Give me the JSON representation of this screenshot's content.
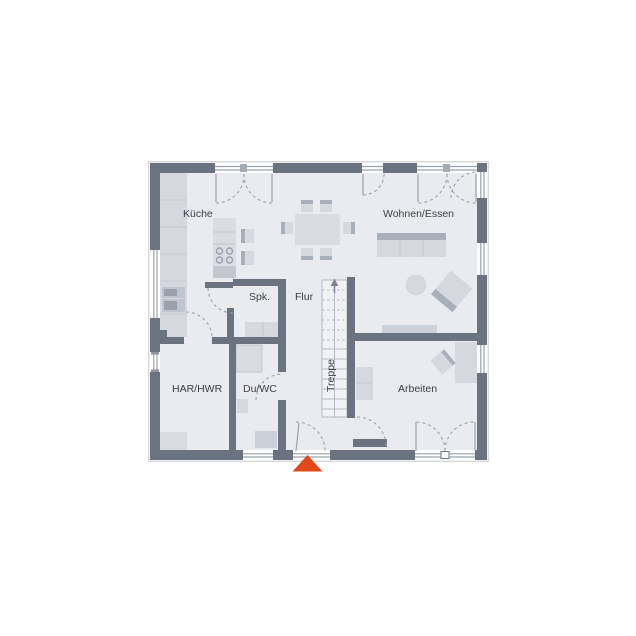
{
  "plan": {
    "type": "floor-plan",
    "language": "de",
    "rooms": {
      "kueche": "Küche",
      "wohnen_essen": "Wohnen/Essen",
      "spk": "Spk.",
      "flur": "Flur",
      "treppe": "Treppe",
      "har_hwr": "HAR/HWR",
      "du_wc": "Du/WC",
      "arbeiten": "Arbeiten"
    },
    "stairs_direction": "up",
    "colors": {
      "wall": "#6c7380",
      "floor": "#e9ebf1",
      "furniture": "#d5d8df",
      "furniture_dark": "#aab0bb",
      "door_arc": "#9aa1ac",
      "label_text": "#3b404a",
      "entrance_arrow": "#e2491a"
    },
    "icons": {
      "entrance_marker": "triangle-up-icon",
      "stair_arrow": "arrow-up-icon"
    }
  }
}
